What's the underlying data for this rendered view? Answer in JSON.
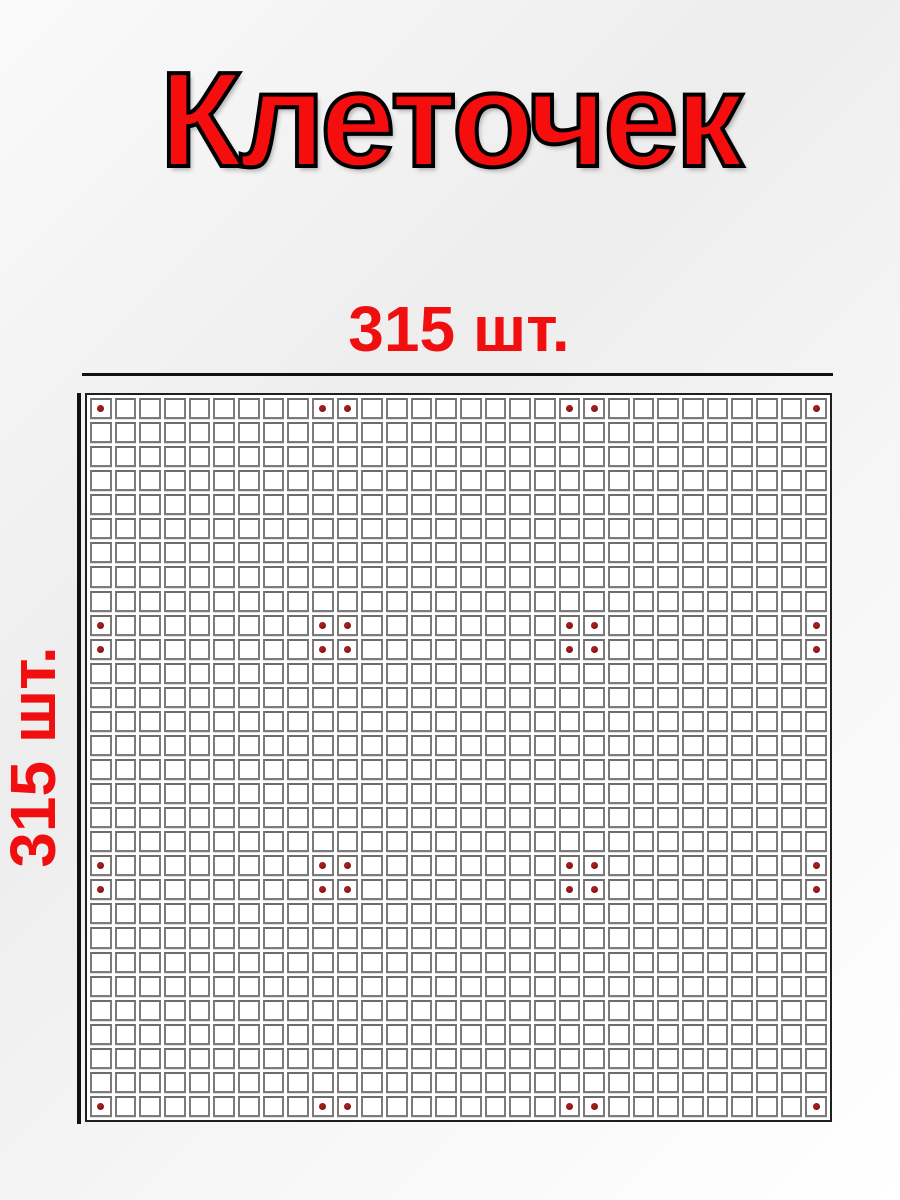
{
  "page": {
    "title": "Клеточек",
    "width_count_label": "315 шт.",
    "height_count_label": "315 шт."
  },
  "grid": {
    "rows": 30,
    "cols": 30,
    "marker_lines": [
      1,
      10,
      11,
      20,
      21,
      30
    ],
    "marker_dot_count": 36,
    "cell_fill_color": "#ffffff",
    "cell_border_color": "#7b7b7b",
    "outer_border_color": "#1f1f1f",
    "dot_color": "#7d1517"
  },
  "colors": {
    "title_red": "#f60d0e",
    "label_red": "#f10e0e",
    "title_outline": "#000000",
    "axis_line": "#111111",
    "background_light": "#ededee"
  }
}
